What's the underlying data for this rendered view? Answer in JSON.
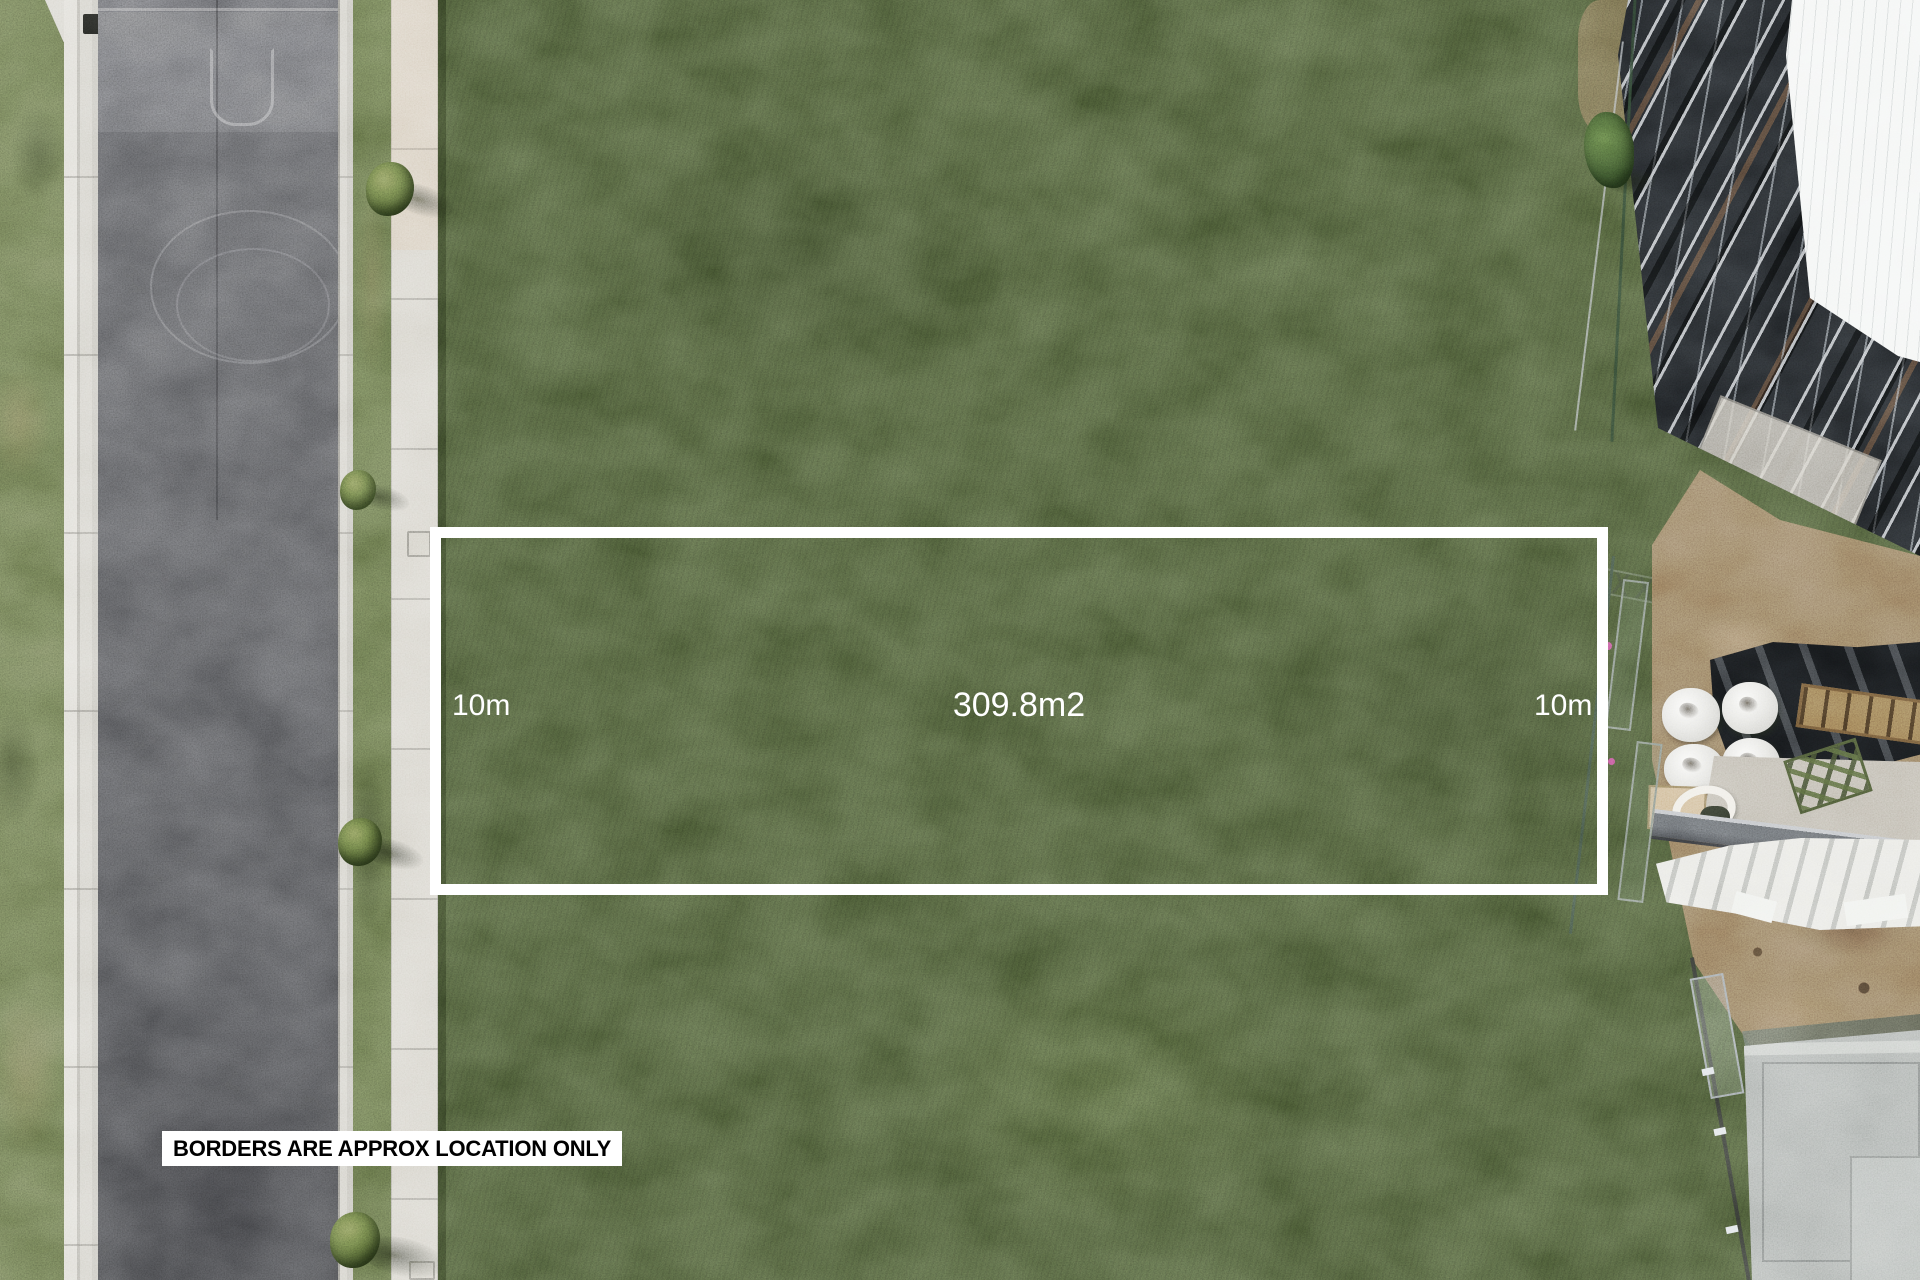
{
  "annotations": {
    "area_label": "309.8m2",
    "width_label_left": "10m",
    "width_label_right": "10m",
    "disclaimer": "BORDERS ARE APPROX LOCATION ONLY"
  },
  "colors": {
    "boundary_line": "#ffffff",
    "label_text": "#ffffff",
    "disclaimer_bg": "#ffffff",
    "disclaimer_text": "#000000",
    "grass_field": "#42502f",
    "grass_verge": "#606c46",
    "road_asphalt": "#4e4f52",
    "concrete_path": "#d3d0c7",
    "dirt": "#8a7154",
    "concrete_slab": "#a7aca9",
    "building_frame": "#1b1e21",
    "roof_sheet": "#f3f5f4"
  }
}
